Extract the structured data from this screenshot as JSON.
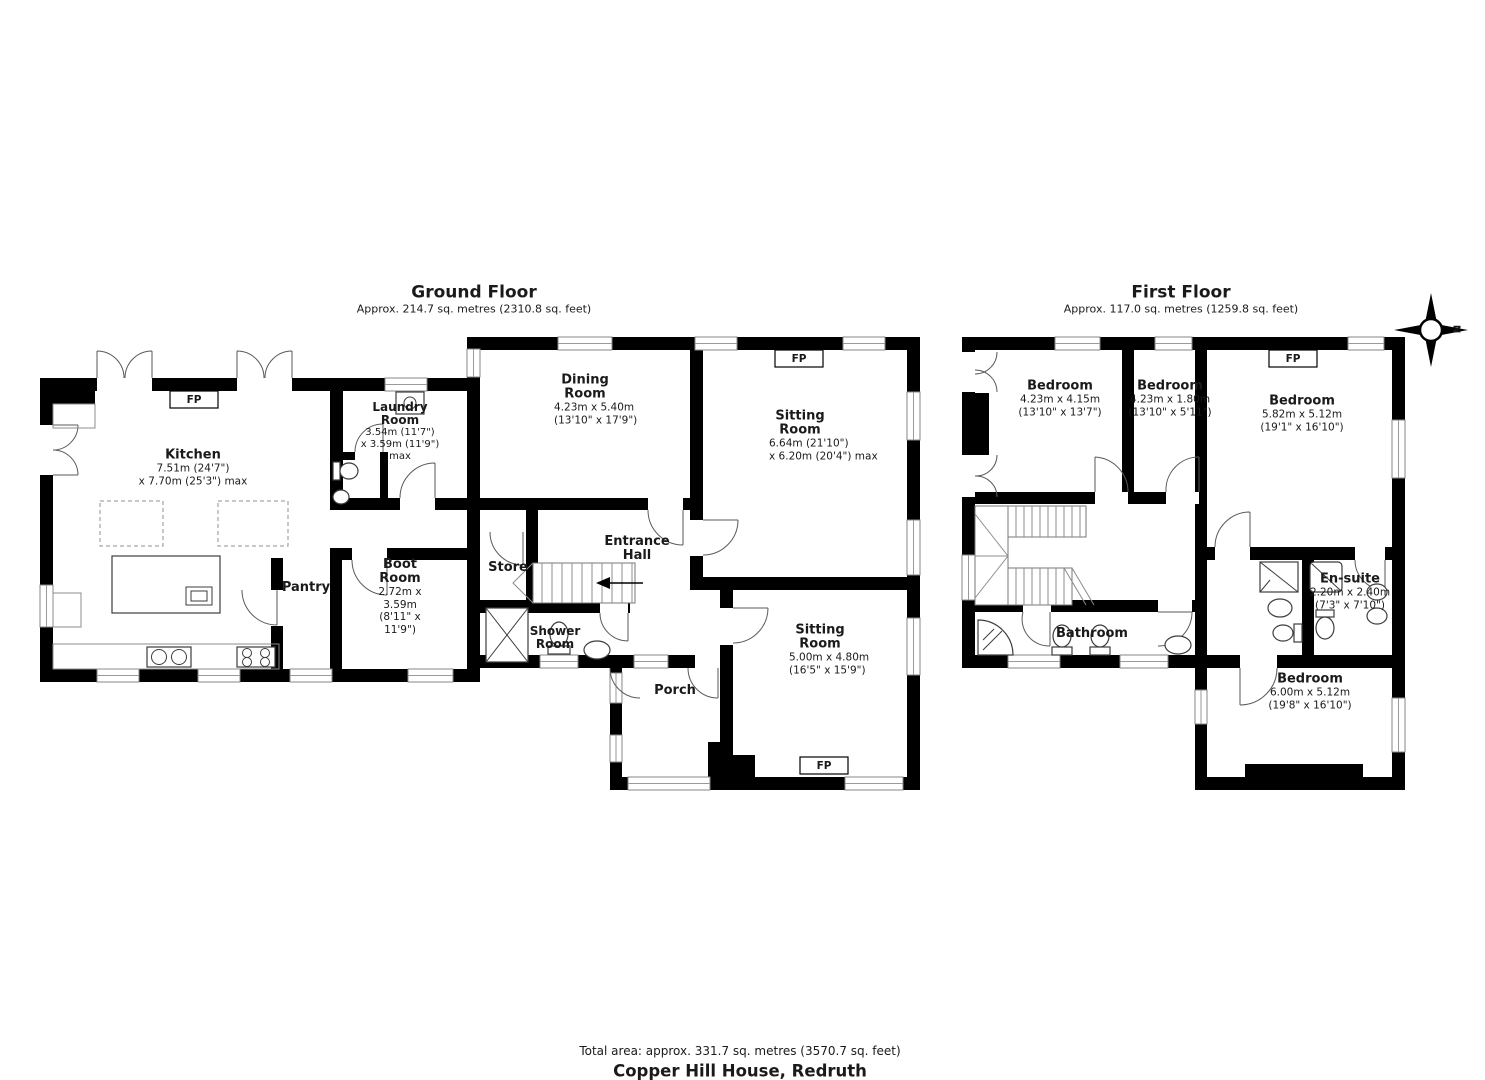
{
  "ground_floor": {
    "title": "Ground Floor",
    "subtitle": "Approx. 214.7 sq. metres (2310.8 sq. feet)",
    "rooms": {
      "kitchen": {
        "name": "Kitchen",
        "dim1": "7.51m (24'7\")",
        "dim2": "x 7.70m (25'3\") max"
      },
      "laundry_room": {
        "name": "Laundry Room",
        "dim1": "3.54m (11'7\")",
        "dim2": "x 3.59m (11'9\") max"
      },
      "pantry": {
        "name": "Pantry"
      },
      "boot_room": {
        "name": "Boot Room",
        "dim1": "2.72m x 3.59m",
        "dim2": "(8'11\" x 11'9\")"
      },
      "store": {
        "name": "Store"
      },
      "entrance_hall": {
        "name": "Entrance Hall"
      },
      "shower_room": {
        "name": "Shower Room"
      },
      "porch": {
        "name": "Porch"
      },
      "dining_room": {
        "name": "Dining Room",
        "dim1": "4.23m x 5.40m",
        "dim2": "(13'10\" x 17'9\")"
      },
      "sitting_room_1": {
        "name": "Sitting Room",
        "dim1": "6.64m (21'10\")",
        "dim2": "x 6.20m (20'4\") max"
      },
      "sitting_room_2": {
        "name": "Sitting Room",
        "dim1": "5.00m x 4.80m",
        "dim2": "(16'5\" x 15'9\")"
      }
    }
  },
  "first_floor": {
    "title": "First Floor",
    "subtitle": "Approx. 117.0 sq. metres (1259.8 sq. feet)",
    "rooms": {
      "bedroom_1": {
        "name": "Bedroom",
        "dim1": "4.23m x 4.15m",
        "dim2": "(13'10\" x 13'7\")"
      },
      "bedroom_2": {
        "name": "Bedroom",
        "dim1": "4.23m x 1.80m",
        "dim2": "(13'10\" x 5'11\")"
      },
      "bedroom_3": {
        "name": "Bedroom",
        "dim1": "5.82m x 5.12m",
        "dim2": "(19'1\" x 16'10\")"
      },
      "en_suite": {
        "name": "En-suite",
        "dim1": "2.20m x 2.40m",
        "dim2": "(7'3\" x 7'10\")"
      },
      "bathroom": {
        "name": "Bathroom"
      },
      "bedroom_4": {
        "name": "Bedroom",
        "dim1": "6.00m x 5.12m",
        "dim2": "(19'8\" x 16'10\")"
      }
    }
  },
  "labels": {
    "fireplace": "FP",
    "compass_north": "N"
  },
  "footer": {
    "total_area": "Total area: approx. 331.7 sq. metres (3570.7 sq. feet)",
    "property_title": "Copper Hill House, Redruth"
  },
  "colors": {
    "wall": "#000000",
    "background": "#ffffff"
  }
}
